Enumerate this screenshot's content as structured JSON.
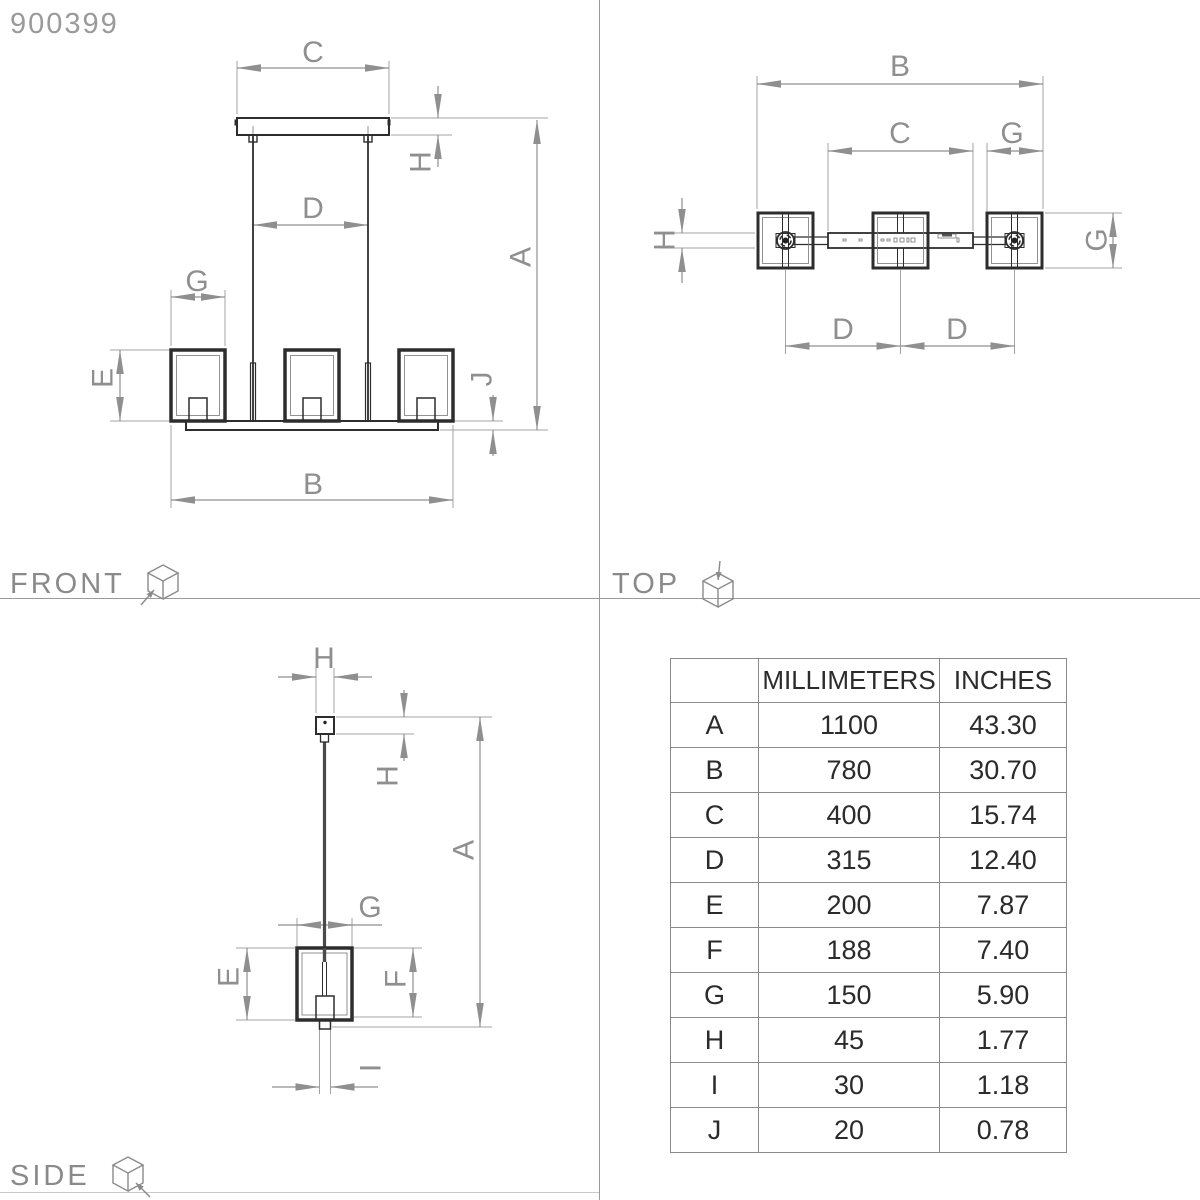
{
  "product_code": "900399",
  "views": {
    "front": {
      "title": "FRONT"
    },
    "top": {
      "title": "TOP"
    },
    "side": {
      "title": "SIDE"
    }
  },
  "letters": {
    "A": "A",
    "B": "B",
    "C": "C",
    "D": "D",
    "E": "E",
    "F": "F",
    "G": "G",
    "H": "H",
    "I": "I",
    "J": "J"
  },
  "table": {
    "headers": {
      "dimension": "",
      "millimeters": "MILLIMETERS",
      "inches": "INCHES"
    },
    "rows": [
      {
        "label": "A",
        "mm": "1100",
        "inches": "43.30"
      },
      {
        "label": "B",
        "mm": "780",
        "inches": "30.70"
      },
      {
        "label": "C",
        "mm": "400",
        "inches": "15.74"
      },
      {
        "label": "D",
        "mm": "315",
        "inches": "12.40"
      },
      {
        "label": "E",
        "mm": "200",
        "inches": "7.87"
      },
      {
        "label": "F",
        "mm": "188",
        "inches": "7.40"
      },
      {
        "label": "G",
        "mm": "150",
        "inches": "5.90"
      },
      {
        "label": "H",
        "mm": "45",
        "inches": "1.77"
      },
      {
        "label": "I",
        "mm": "30",
        "inches": "1.18"
      },
      {
        "label": "J",
        "mm": "20",
        "inches": "0.78"
      }
    ]
  },
  "colors": {
    "object_line": "#2d2d2d",
    "dimension_line": "#8f8f8f",
    "label_text": "#8f8f8f",
    "table_text": "#2b2b2b"
  }
}
